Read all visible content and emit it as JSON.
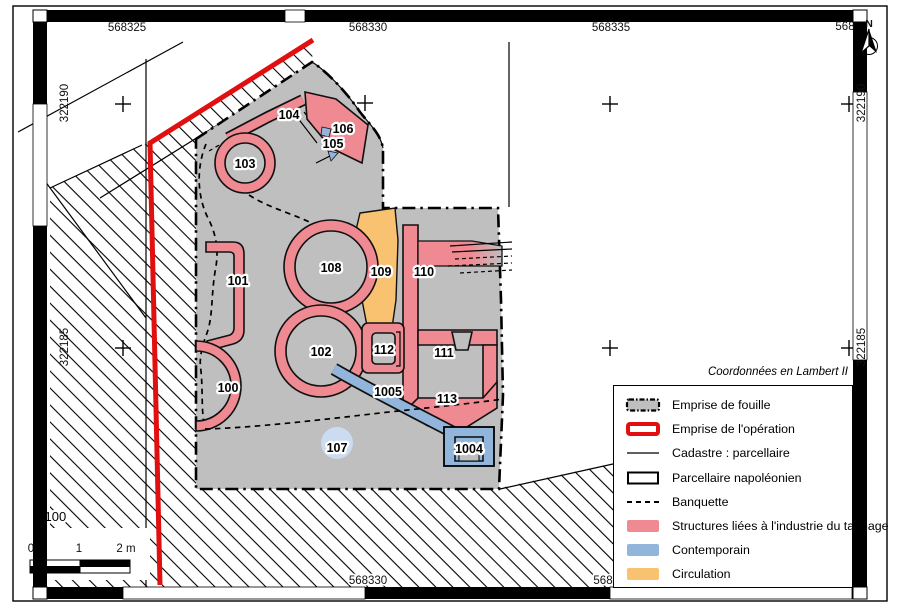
{
  "map": {
    "north_label": "N",
    "scale_ratio": "1/100",
    "scale_ticks": {
      "t0": "0",
      "t1": "1",
      "t2": "2 m"
    },
    "coord_note": "Coordonnées en Lambert II",
    "coords": {
      "top_1": "568325",
      "top_2": "568330",
      "top_3": "568335",
      "top_4": "568",
      "bottom_1": "568330",
      "bottom_2": "568",
      "left_1": "322190",
      "left_2": "322185",
      "right_1": "322190",
      "right_2": "322185"
    },
    "features": {
      "f100": "100",
      "f101": "101",
      "f102": "102",
      "f103": "103",
      "f104": "104",
      "f105": "105",
      "f106": "106",
      "f107": "107",
      "f108": "108",
      "f109": "109",
      "f110": "110",
      "f111": "111",
      "f112": "112",
      "f113": "113",
      "f1004": "1004",
      "f1005": "1005"
    },
    "legend": {
      "items": [
        {
          "label": "Emprise de fouille",
          "swatch": "fouille-gray-dashdot-rect"
        },
        {
          "label": "Emprise de l'opération",
          "swatch": "red-thick-rect"
        },
        {
          "label": "Cadastre : parcellaire",
          "swatch": "thin-line"
        },
        {
          "label": "Parcellaire napoléonien",
          "swatch": "black-rect"
        },
        {
          "label": "Banquette",
          "swatch": "dashed-line"
        },
        {
          "label": "Structures liées à l'industrie du tannage",
          "swatch": "pink-fill"
        },
        {
          "label": "Contemporain",
          "swatch": "blue-fill"
        },
        {
          "label": "Circulation",
          "swatch": "orange-fill"
        }
      ]
    },
    "colors": {
      "tannage": "#F08A92",
      "contemporain": "#92B5DC",
      "circulation": "#F8C271",
      "fouille_gray": "#BFBFBF",
      "operation_red": "#E10F0F",
      "halo_blue": "#CBDCF1"
    }
  }
}
